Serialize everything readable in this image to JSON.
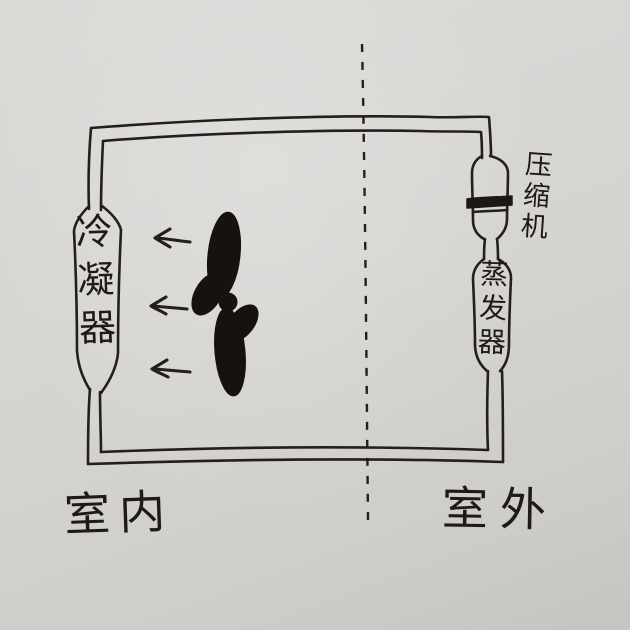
{
  "colors": {
    "paper": "#d7d5d2",
    "ink": "#221f1c"
  },
  "components": {
    "condenser": {
      "label": "冷凝器"
    },
    "compressor": {
      "label": "压缩机"
    },
    "evaporator": {
      "label": "蒸发器"
    }
  },
  "zones": {
    "indoor": {
      "label": "室内"
    },
    "outdoor": {
      "label": "室外"
    }
  },
  "airflow": {
    "direction": "left",
    "arrow_count": 3
  },
  "partition": {
    "style": "dashed-vertical-line"
  }
}
